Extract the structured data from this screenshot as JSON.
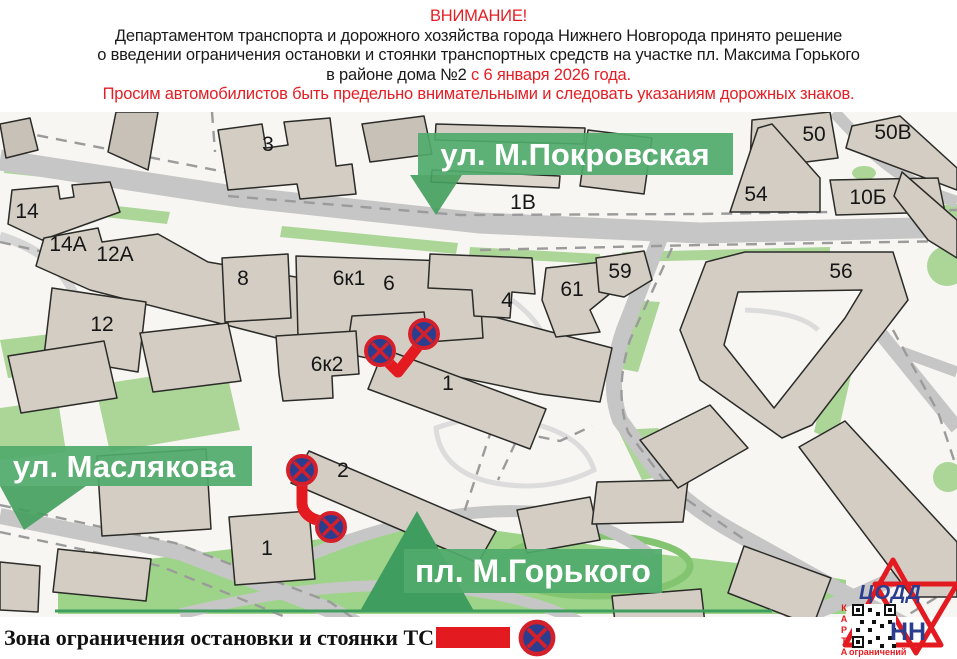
{
  "header": {
    "line1": "ВНИМАНИЕ!",
    "line2": "Департаментом транспорта и дорожного хозяйства города Нижнего Новгорода принято решение",
    "line3": "о введении ограничения остановки и стоянки транспортных средств на участке пл. Максима Горького",
    "line4_black": "в районе дома №2",
    "line4_red": " с 6 января 2026 года.",
    "line5": "Просим автомобилистов быть предельно внимательными и следовать указаниям дорожных знаков."
  },
  "map": {
    "streets": [
      {
        "name": "ул. М.Покровская"
      },
      {
        "name": "ул. Маслякова"
      },
      {
        "name": "пл. М.Горького"
      }
    ],
    "buildings": [
      {
        "label": "3"
      },
      {
        "label": "1В"
      },
      {
        "label": "14"
      },
      {
        "label": "14А"
      },
      {
        "label": "12А"
      },
      {
        "label": "12"
      },
      {
        "label": "8"
      },
      {
        "label": "6к1"
      },
      {
        "label": "6"
      },
      {
        "label": "4"
      },
      {
        "label": "61"
      },
      {
        "label": "59"
      },
      {
        "label": "50"
      },
      {
        "label": "50В"
      },
      {
        "label": "54"
      },
      {
        "label": "10Б"
      },
      {
        "label": "56"
      },
      {
        "label": "6к2"
      },
      {
        "label": "1"
      },
      {
        "label": "2"
      },
      {
        "label": "1"
      }
    ],
    "colors": {
      "accent_red": "#e31a20",
      "sign_blue": "#2a3d8f",
      "street_label_green": "#4faa6b",
      "map_green": "#abd697",
      "building_fill": "#d4cdc4",
      "road_gray": "#c6c6c6"
    }
  },
  "legend": {
    "label": "Зона ограничения остановки и стоянки ТС -"
  },
  "logo": {
    "org": "ЦОДД",
    "city": "НН",
    "qr_vertical": "КАРТА",
    "qr_caption": "ограничений"
  }
}
